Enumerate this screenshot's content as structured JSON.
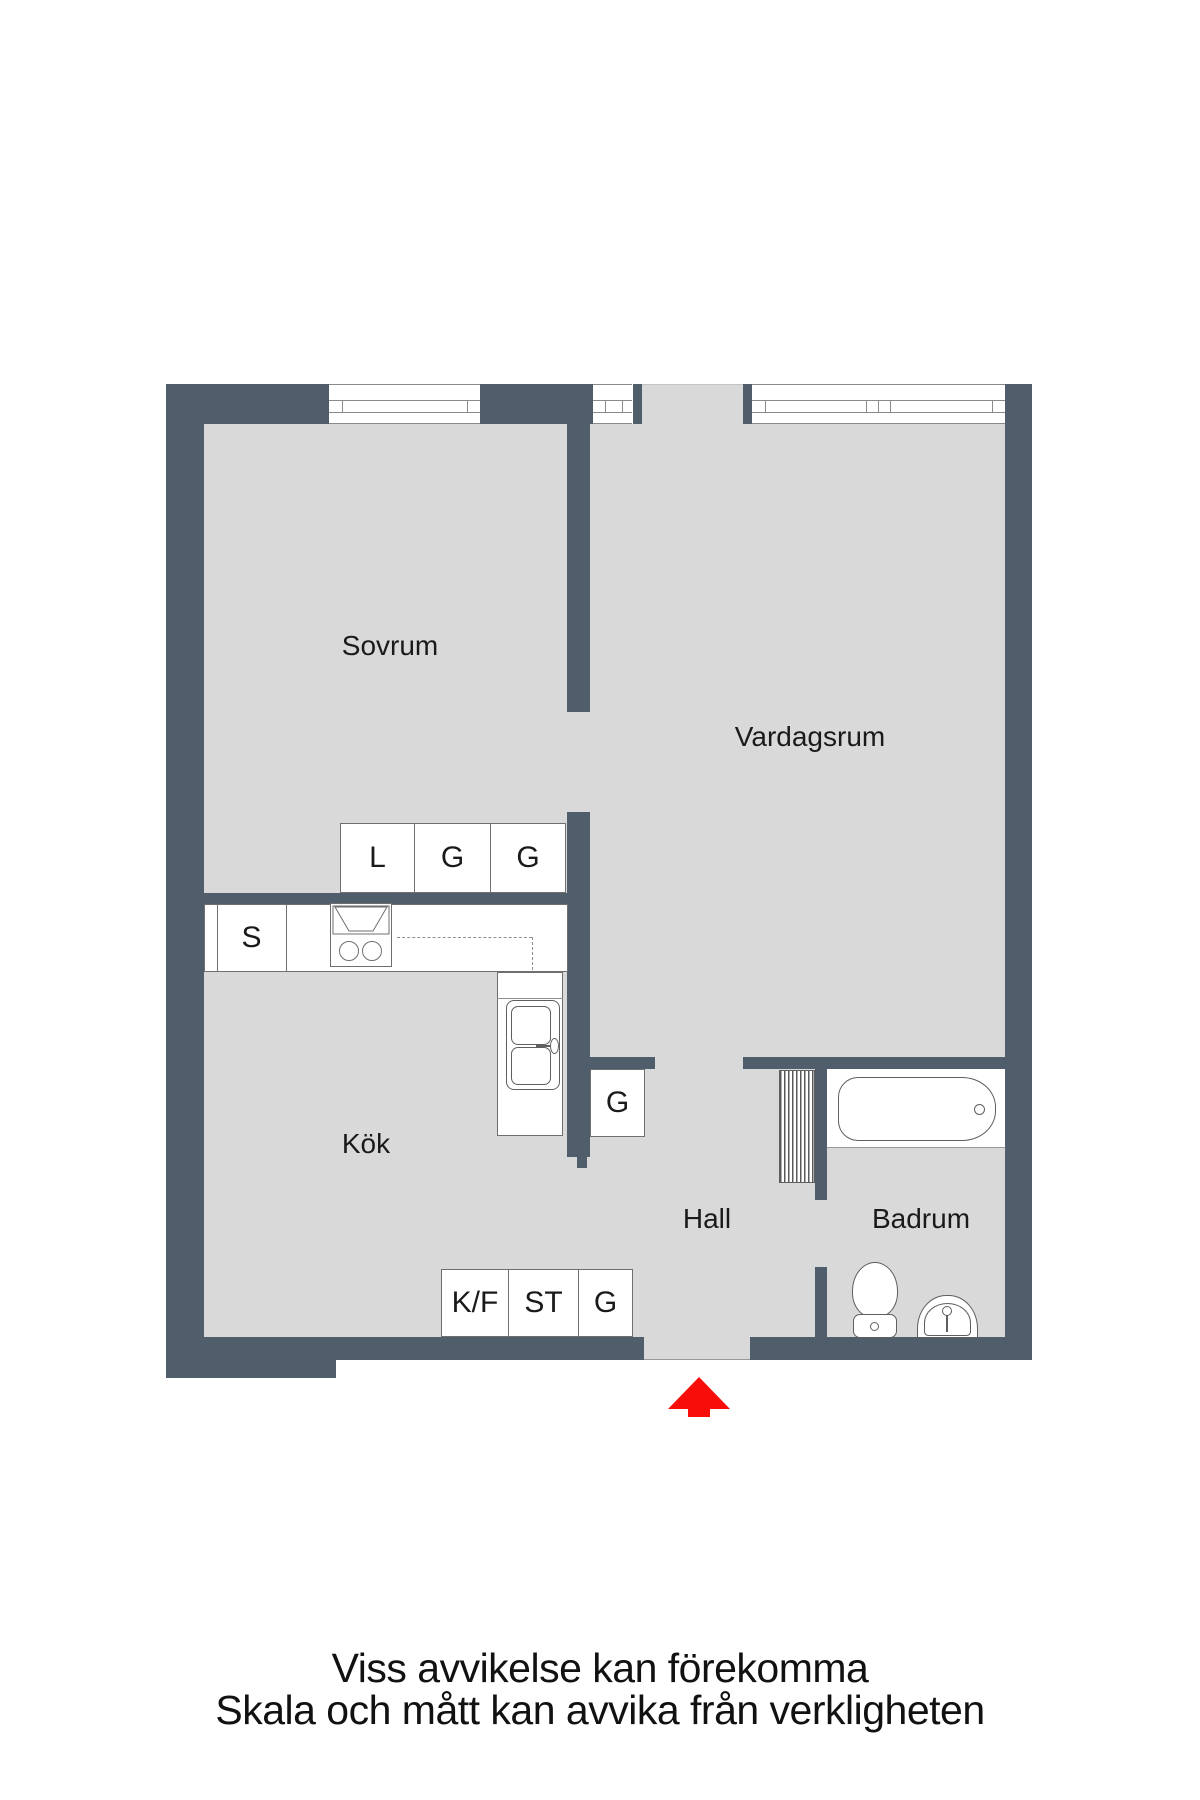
{
  "labels": {
    "sovrum": "Sovrum",
    "vardagsrum": "Vardagsrum",
    "kok": "Kök",
    "hall": "Hall",
    "badrum": "Badrum"
  },
  "cabinets": {
    "closet_l": "L",
    "closet_g1": "G",
    "closet_g2": "G",
    "counter_s": "S",
    "hall_g": "G",
    "entry_kf": "K/F",
    "entry_st": "ST",
    "entry_g": "G"
  },
  "footer": {
    "line1": "Viss avvikelse kan förekomma",
    "line2": "Skala och mått kan avvika från verkligheten"
  },
  "colors": {
    "wall": "#4f5e6a",
    "floor": "#d9d9d9",
    "arrow_red": "#f80d0b"
  }
}
